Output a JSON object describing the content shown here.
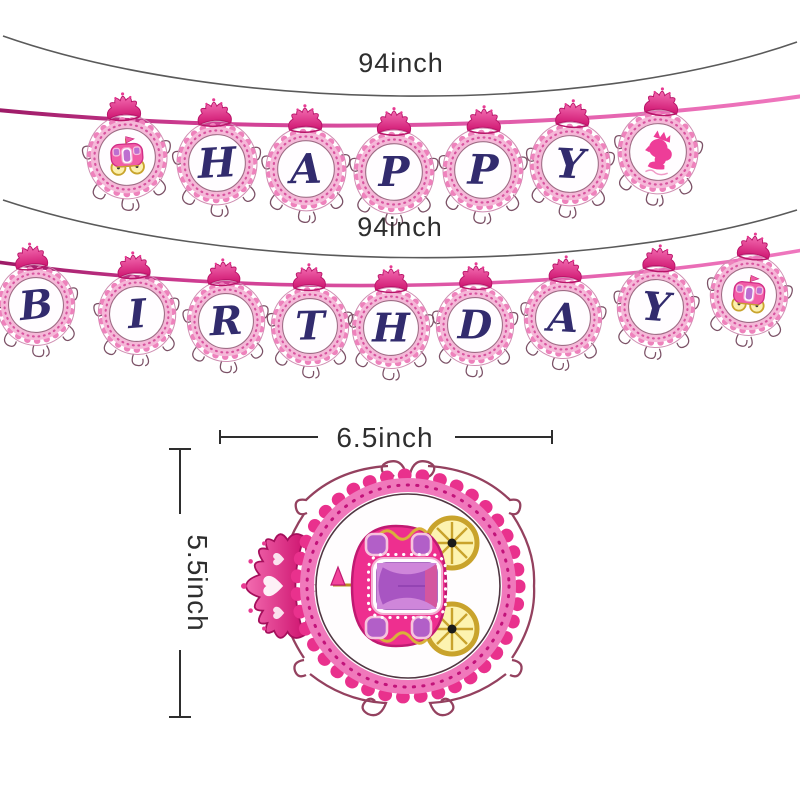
{
  "product_image": {
    "type": "princess-birthday-banner-dimension-diagram",
    "background": "#ffffff"
  },
  "banners": {
    "top": {
      "length_label": "94inch",
      "pendant_sequence": [
        "carriage",
        "H",
        "A",
        "P",
        "P",
        "Y",
        "princess"
      ],
      "letters": [
        "H",
        "A",
        "P",
        "P",
        "Y"
      ]
    },
    "bottom": {
      "length_label": "94inch",
      "pendant_sequence": [
        "B",
        "I",
        "R",
        "T",
        "H",
        "D",
        "A",
        "Y",
        "carriage"
      ],
      "letters": [
        "B",
        "I",
        "R",
        "T",
        "H",
        "D",
        "A",
        "Y"
      ]
    }
  },
  "detail_pendant": {
    "width_label": "6.5inch",
    "height_label": "5.5inch",
    "motif": "princess-carriage",
    "orientation": "rotated-90-ccw"
  },
  "icons": {
    "crown": "crown-icon",
    "carriage": "carriage-icon",
    "princess": "princess-cameo-icon"
  },
  "colors": {
    "ribbon_magenta": "#c43c90",
    "scallop_hot_pink": "#e9318d",
    "band_light_pink": "#f5b8d8",
    "crown_pink": "#e5307f",
    "letter_navy": "#322b6e",
    "carriage_pink": "#ee2f8f",
    "wheel_gold": "#c9a42e",
    "curtain_purple": "#b25fc8",
    "frame_maroon": "#8b3152",
    "dimension_ink": "#2e2e2e"
  }
}
